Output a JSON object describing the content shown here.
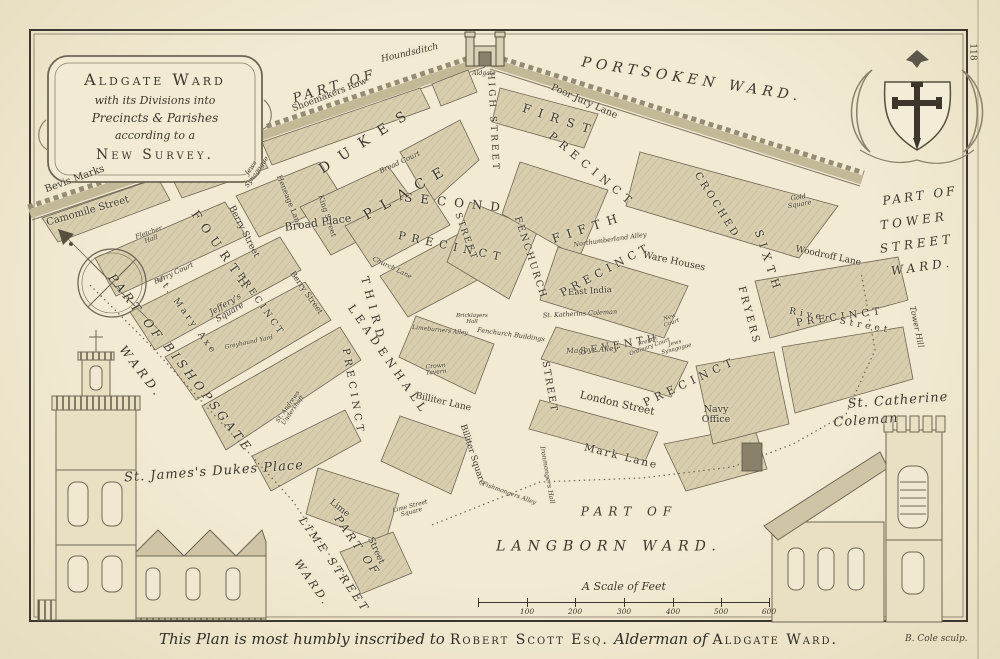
{
  "plate": {
    "number": "118",
    "engraver": "B. Cole sculp."
  },
  "colors": {
    "parchment": "#f2ead3",
    "ink": "#3d382d",
    "block_fill": "#d8ceae",
    "wall": "#c3b997"
  },
  "cartouche": {
    "line1": "Aldgate Ward",
    "line2": "with its Divisions into",
    "line3": "Precincts & Parishes",
    "line4": "according to a",
    "line5": "New Survey."
  },
  "dedication": {
    "part1": "This Plan is most humbly inscribed to",
    "part2": "Robert Scott Esq.",
    "part3": "Alderman of",
    "part4": "Aldgate Ward."
  },
  "scale_bar": {
    "title": "A Scale of Feet",
    "ticks": [
      "100",
      "200",
      "300",
      "400",
      "500",
      "600"
    ]
  },
  "wards": {
    "portsoken_part": "PART OF",
    "portsoken_name": "PORTSOKEN WARD.",
    "tower_part": "PART OF",
    "tower_name1": "TOWER",
    "tower_name2": "STREET",
    "tower_name3": "WARD.",
    "bishopsgate_part": "PART OF",
    "bishopsgate_name": "BISHOPSGATE",
    "bishopsgate_ward": "WARD.",
    "limestreet_part": "PART OF",
    "limestreet_name": "LIME STREET",
    "limestreet_ward": "WARD.",
    "langborn_part": "PART OF",
    "langborn_name": "LANGBORN WARD."
  },
  "precincts": {
    "first_name": "FIRST",
    "first_word": "PRECINCT",
    "second_name": "SECOND",
    "second_word": "PRECINCT",
    "third_name": "THIRD",
    "third_word": "PRECINCT",
    "fourth_name": "FOURTH",
    "fourth_word": "PRECINCT",
    "fifth_name": "FIFTH",
    "fifth_word": "PRECINCT",
    "sixth_name": "SIXTH",
    "sixth_word": "PRECINCT",
    "seventh_name": "SEVENTH",
    "seventh_word": "PRECINCT"
  },
  "streets": {
    "houndsditch": "Houndsditch",
    "camomile_street": "Camomile Street",
    "bevis_marks": "Bevis Marks",
    "shoemakers_row": "Shoemakers Row",
    "dukes": "DUKES",
    "place": "PLACE",
    "high_street": "HIGH STREET",
    "poor_jury_lane": "Poor Jury Lane",
    "croched": "CROCHED",
    "fryers": "FRYERS",
    "heneage_lane": "Heneage Lane",
    "king_street": "King Street",
    "berry_street_upper": "Berry Street",
    "berry_street_lower": "Berry Street",
    "st_mary_axe": "St. Mary Axe",
    "leadenhall": "LEADENHALL",
    "leadenhall_street_word": "STREET",
    "fenchurch": "FENCHURCH",
    "fenchurch_street_word": "STREET",
    "woodroff_lane": "Woodroff Lane",
    "river_street": "River Street",
    "tower_hill": "Tower Hill",
    "london_street": "London Street",
    "mark_lane": "Mark Lane",
    "billiter_lane": "Billiter Lane",
    "billiter_square": "Billiter Square",
    "lime": "Lime",
    "lime_street_word": "Street",
    "church_lane": "Church Lane",
    "magpye_alley": "Magpye Alley",
    "northumberland_alley": "Northumberland Alley",
    "limeburners_alley": "Limeburners Alley",
    "fishmongers_alley": "Fishmongers Alley"
  },
  "places": {
    "aldgate": "Aldgate",
    "broad_place": "Broad Place",
    "broad_court": "Broad Court",
    "jews_synagogue_w": "Jews Synagogue",
    "jews_synagogue_e": "Jews Synagogue",
    "berry_court": "Berry Court",
    "jefferys_square": "Jeffery's Square",
    "fletcher_hall": "Fletcher Hall",
    "greyhound_yard": "Greyhound Yard",
    "gold_square": "Gold Square",
    "ware_houses": "Ware Houses",
    "east_india": "East India",
    "st_katherins_coleman": "St. Katherins Coleman",
    "french_ordinary_court": "French Ordinary Court",
    "new_court": "New Court",
    "navy_office": "Navy Office",
    "fenchurch_buildings": "Fenchurch Buildings",
    "bricklayers_hall": "Bricklayers Hall",
    "crown_tavern": "Crown Tavern",
    "lime_street_square": "Lime Street Square",
    "ironmongers_hall": "Ironmongers Hall",
    "st_andrews_undershaft": "St. Andrews Undershaft"
  },
  "churches": {
    "st_james": "St. James's Dukes Place",
    "st_catherine_1": "St. Catherine",
    "st_catherine_2": "Coleman"
  }
}
